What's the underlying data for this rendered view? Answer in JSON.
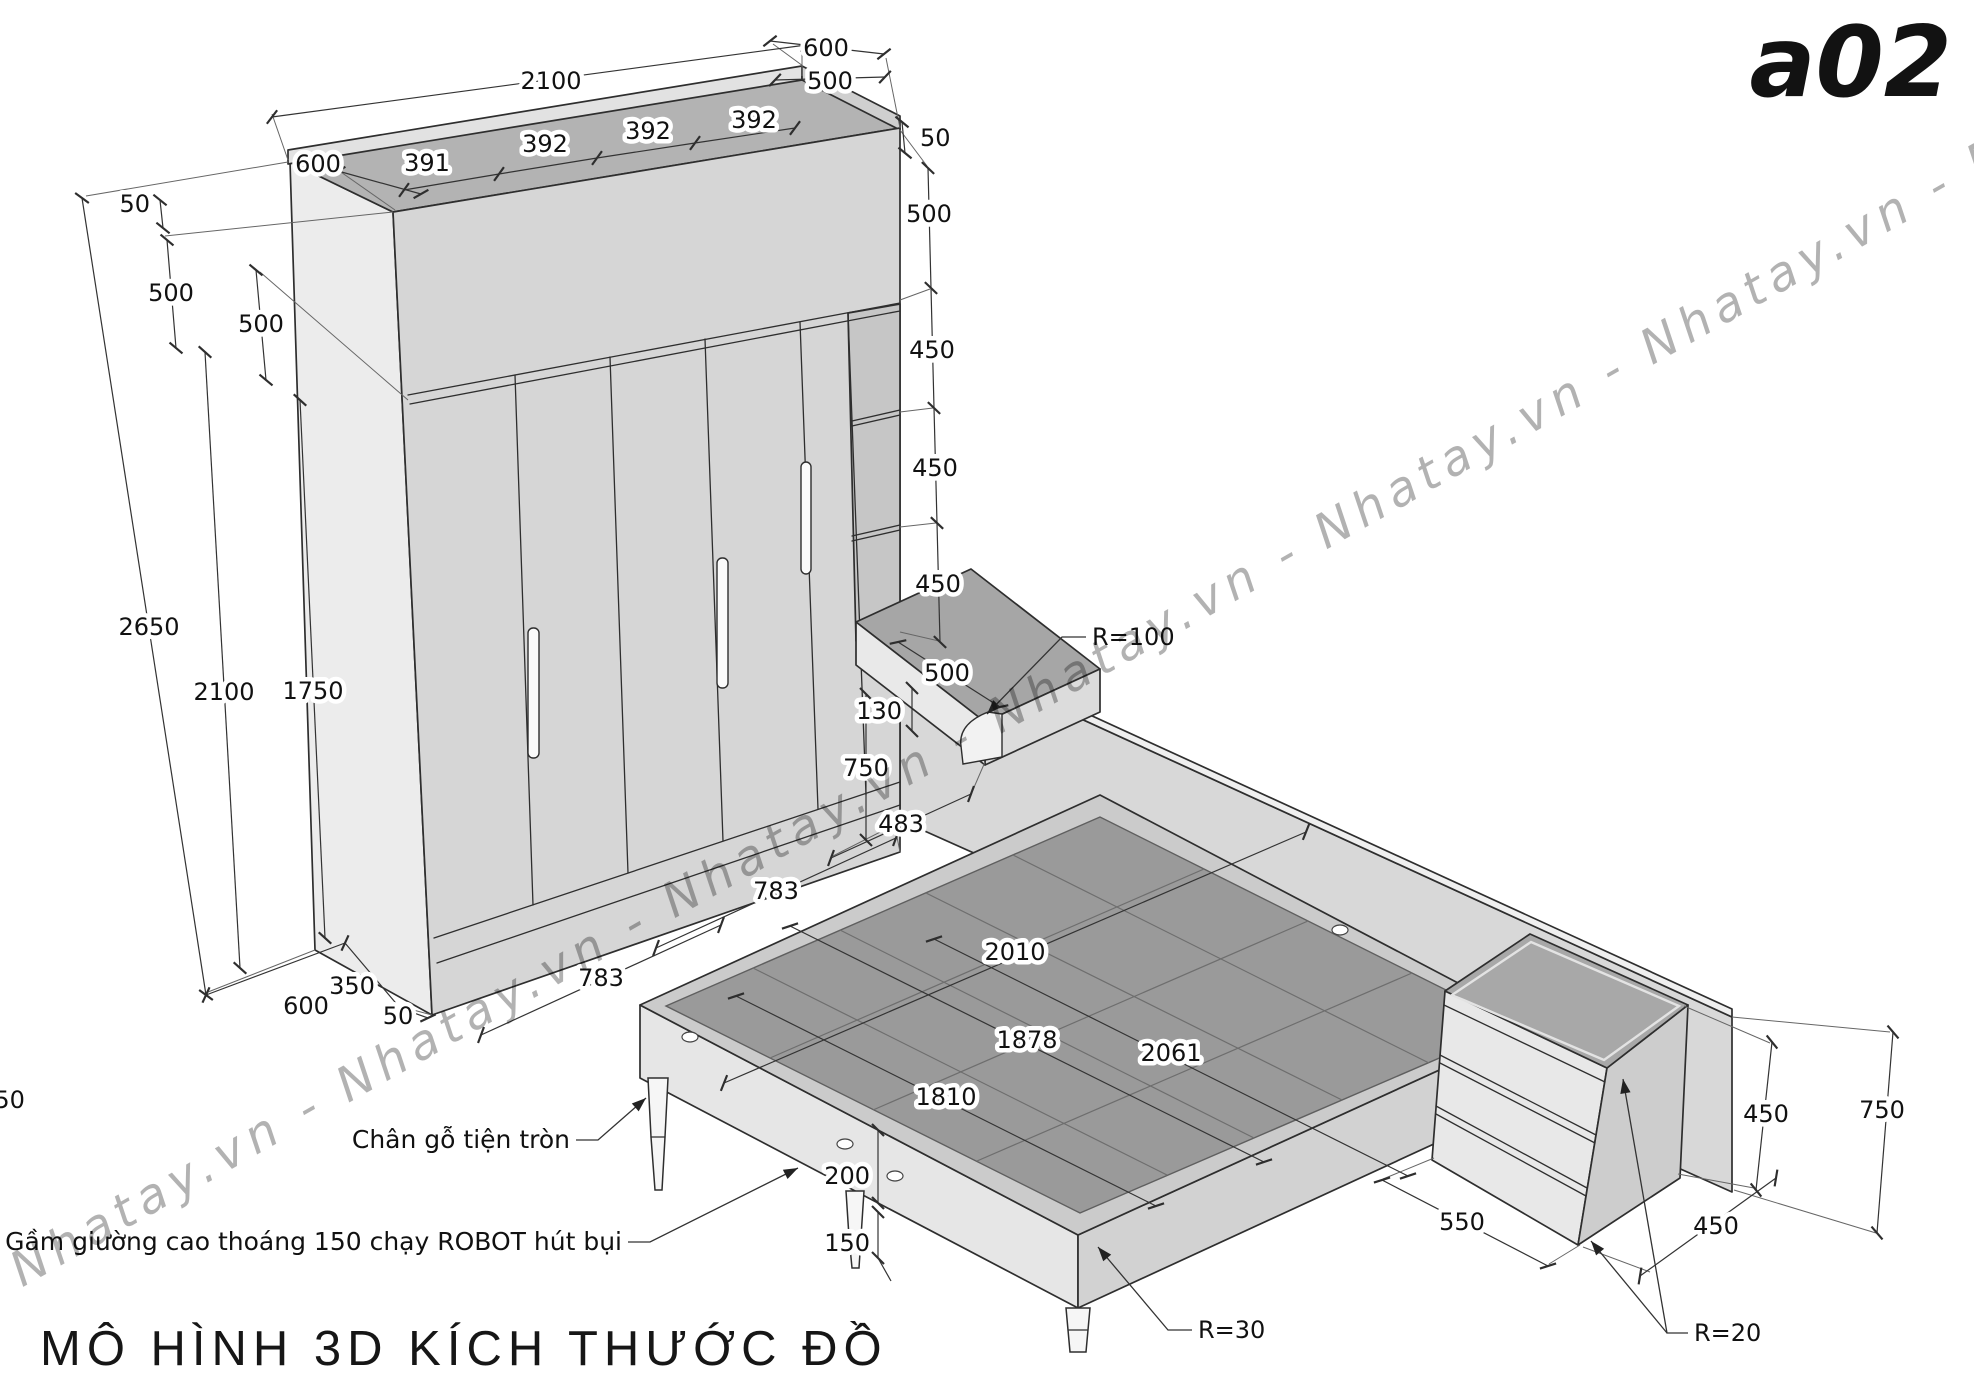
{
  "page": {
    "code": "a02",
    "title": "MÔ HÌNH 3D KÍCH THƯỚC ĐỒ",
    "watermark": "Nhatay.vn - Nhatay.vn - Nhatay.vn - Nhatay.vn - Nhatay.vn - Nhatay.vn - Nhatay.vn"
  },
  "colors": {
    "line": "#2e2e2e",
    "wardrobe_front": "#d6d6d6",
    "wardrobe_side": "#ededed",
    "wardrobe_top": "#b3b3b3",
    "wall": "#d8d8d8",
    "bed_top": "#9a9a9a",
    "bed_rim": "#cbcbcb",
    "shelf_top": "#a6a6a6",
    "watermark": "rgba(0,0,0,0.30)"
  },
  "wardrobe": {
    "w2100": "2100",
    "w600_left": "600",
    "w391": "391",
    "w392_1": "392",
    "w392_2": "392",
    "w392_3": "392",
    "w600_right": "600",
    "w500_top_right": "500",
    "w50_right": "50",
    "h50_left": "50",
    "h500_outer": "500",
    "h500_inner": "500",
    "h2650": "2650",
    "h2100": "2100",
    "h1750": "1750",
    "right_500": "500",
    "right_450_1": "450",
    "right_450_2": "450",
    "right_450_3": "450",
    "base_600": "600",
    "base_350": "350",
    "base_50": "50",
    "edge_750": "750"
  },
  "shelf": {
    "d500": "500",
    "t130": "130",
    "h750": "750",
    "g483": "483",
    "radius": "R=100"
  },
  "floor": {
    "g783_1": "783",
    "g783_2": "783"
  },
  "bed": {
    "l2010": "2010",
    "w1878": "1878",
    "l2061": "2061",
    "w1810": "1810",
    "h200": "200",
    "h150": "150",
    "radius": "R=30",
    "leg_note": "Chân gỗ tiện tròn",
    "clearance_note": "Gầm giường cao thoáng 150 chạy ROBOT hút bụi"
  },
  "nightstand": {
    "d550": "550",
    "w450": "450",
    "h450": "450",
    "h750": "750",
    "radius": "R=20"
  }
}
